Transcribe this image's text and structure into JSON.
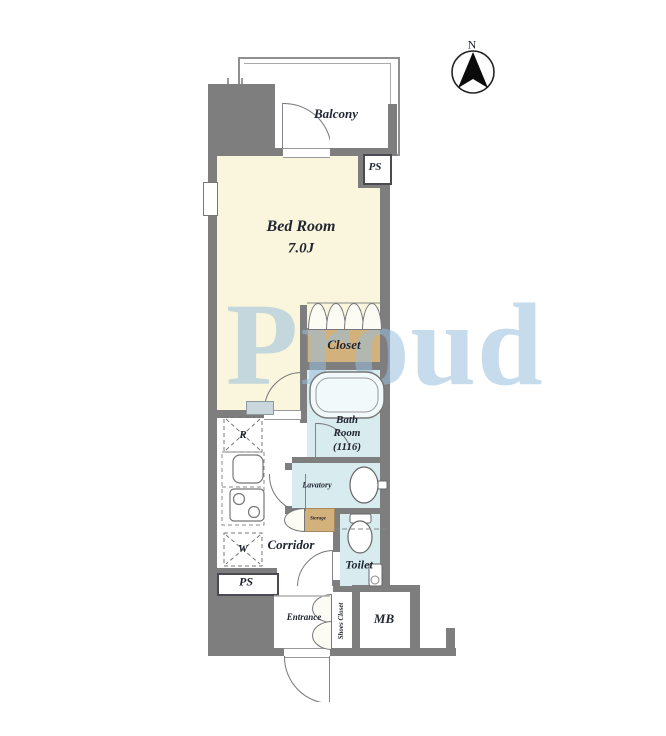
{
  "compass": {
    "north": "N"
  },
  "labels": {
    "balcony": "Balcony",
    "bedroom_name": "Bed Room",
    "bedroom_size": "7.0J",
    "ps_top": "PS",
    "closet": "Closet",
    "bath_1": "Bath",
    "bath_2": "Room",
    "bath_3": "(1116)",
    "lavatory": "Lavatory",
    "storage": "Storage",
    "corridor": "Corridor",
    "toilet": "Toilet",
    "refrigerator_mark": "R",
    "washer_mark": "W",
    "ps_bottom": "PS",
    "entrance": "Entrance",
    "shoes_closet": "Shoes Closet",
    "meter_box": "MB"
  },
  "watermark": {
    "text": "Proud"
  },
  "colors": {
    "wall": "#7e7e7e",
    "bedroom_floor": "#faf6dd",
    "wet_area_floor": "#d8ecf0",
    "closet_fill": "#d3b17d",
    "watermark": "#98bedb"
  }
}
